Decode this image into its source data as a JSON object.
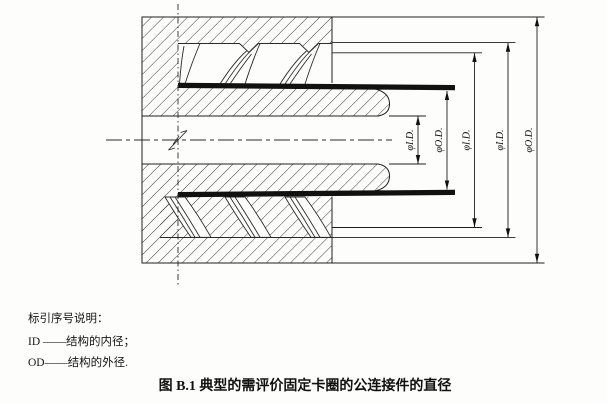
{
  "drawing": {
    "dimension_labels": [
      {
        "name": "tube-inner-diameter",
        "label": "φI.D."
      },
      {
        "name": "tube-outer-diameter",
        "label": "φO.D."
      },
      {
        "name": "collar-thread-crest-inner-diameter",
        "label": "φI.D."
      },
      {
        "name": "collar-thread-root-inner-diameter",
        "label": "φI.D."
      },
      {
        "name": "collar-outer-diameter",
        "label": "φO.D."
      }
    ]
  },
  "legend": {
    "title": "标引序号说明：",
    "items": [
      {
        "label": "ID ——结构的内径；"
      },
      {
        "label": "OD——结构的外径."
      }
    ]
  },
  "caption": "图 B.1  典型的需评价固定卡圈的公连接件的直径"
}
